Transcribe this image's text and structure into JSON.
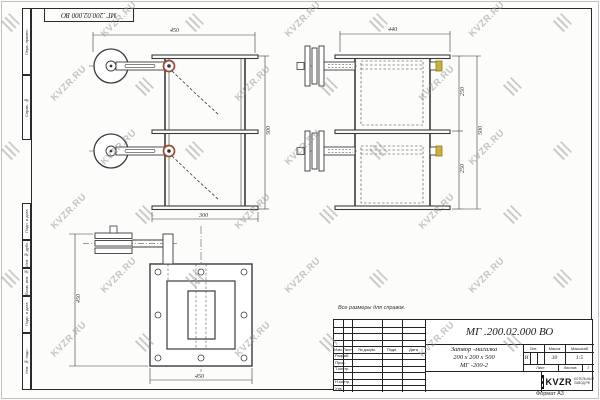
{
  "watermark": {
    "text": "KVZR.RU"
  },
  "stamp_top": "МГ .200.02.000 ВО",
  "note": "Все размеры для справок.",
  "format_label": "Формат А3",
  "frame_labels": [
    "Перв. примен.",
    "Справ. №",
    "Подп. и дата",
    "Инв. № дубл.",
    "Взам. инв. №",
    "Подп. и дата",
    "Инв. № подл."
  ],
  "title_block": {
    "doc_number": "МГ .200.02.000 ВО",
    "name_line1": "Затвор -мигалка",
    "name_line2": "200 х 200 х 500",
    "name_line3": "МГ -200-2",
    "lit_header": "Лит.",
    "mass_header": "Масса",
    "scale_header": "Масштаб",
    "lit_value": "И",
    "mass_value": "30",
    "scale_value": "1:5",
    "sheet_header": "Лист",
    "sheets_header": "Листов",
    "sheets_value": "1",
    "header_cols": [
      "Изм.",
      "Лист",
      "№ докум.",
      "Подп.",
      "Дата"
    ],
    "rows": [
      "Разраб.",
      "Пров.",
      "Т.контр.",
      "Н.контр.",
      "Утв."
    ],
    "logo_text": "KVZR",
    "logo_sub1": "КОТЕЛЬНЫЙ",
    "logo_sub2": "ЗАВОД РФ"
  },
  "views": {
    "front": {
      "dims": {
        "width": "450",
        "height": "500",
        "base": "300"
      }
    },
    "side": {
      "dims": {
        "width": "440",
        "upper": "250",
        "lower": "250",
        "height": "500"
      }
    },
    "plan": {
      "dims": {
        "width": "450",
        "height": "450"
      }
    }
  }
}
